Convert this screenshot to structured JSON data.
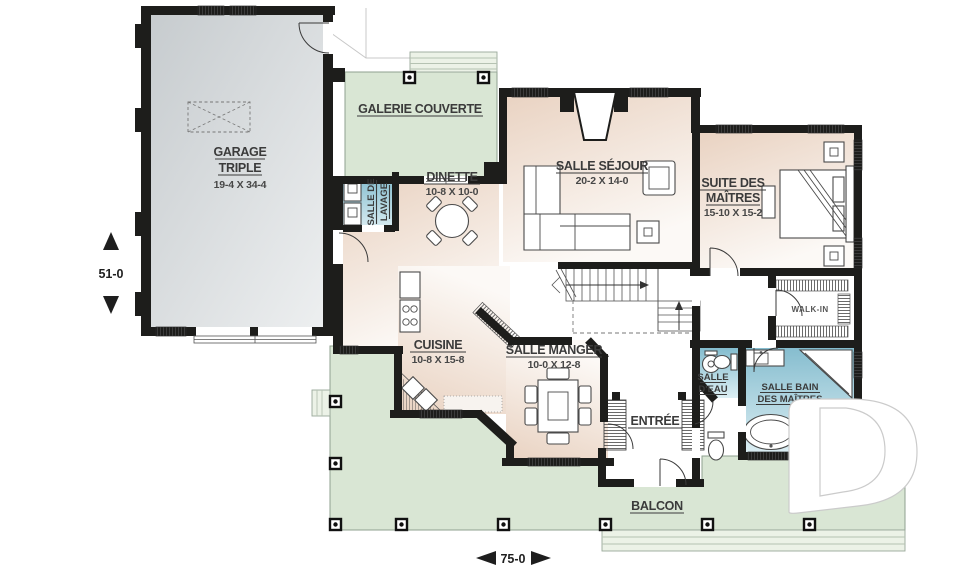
{
  "plan_title": "first-floor-plan",
  "rooms": {
    "garage": {
      "line1": "GARAGE",
      "line2": "TRIPLE",
      "dims": "19-4 X 34-4"
    },
    "galerie": {
      "name": "GALERIE COUVERTE"
    },
    "dinette": {
      "name": "DINETTE",
      "dims": "10-8 X 10-0"
    },
    "lavage": {
      "line1": "SALLE DE",
      "line2": "LAVAGE"
    },
    "sejour": {
      "name": "SALLE SÉJOUR",
      "dims": "20-2 X 14-0"
    },
    "suite": {
      "line1": "SUITE DES",
      "line2": "MAÎTRES",
      "dims": "15-10 X 15-2"
    },
    "walkin": {
      "name": "WALK-IN"
    },
    "cuisine": {
      "name": "CUISINE",
      "dims": "10-8 X 15-8"
    },
    "manger": {
      "name": "SALLE MANGER",
      "dims": "10-0 X 12-8"
    },
    "eau": {
      "line1": "SALLE",
      "line2": "D'EAU"
    },
    "bain": {
      "line1": "SALLE BAIN",
      "line2": "DES MAÎTRES"
    },
    "entree": {
      "name": "ENTRÉE"
    },
    "balcon": {
      "name": "BALCON"
    }
  },
  "dimensions": {
    "height": "51-0",
    "width": "75-0"
  },
  "colors": {
    "wall": "#1d1d1b",
    "porch_green": "#d9e6d4",
    "garage_gray": "#ccd0d3",
    "interior_beige": "#e9d2c1",
    "bath_blue": "#84bcce",
    "label_text": "#3b3b3b"
  }
}
